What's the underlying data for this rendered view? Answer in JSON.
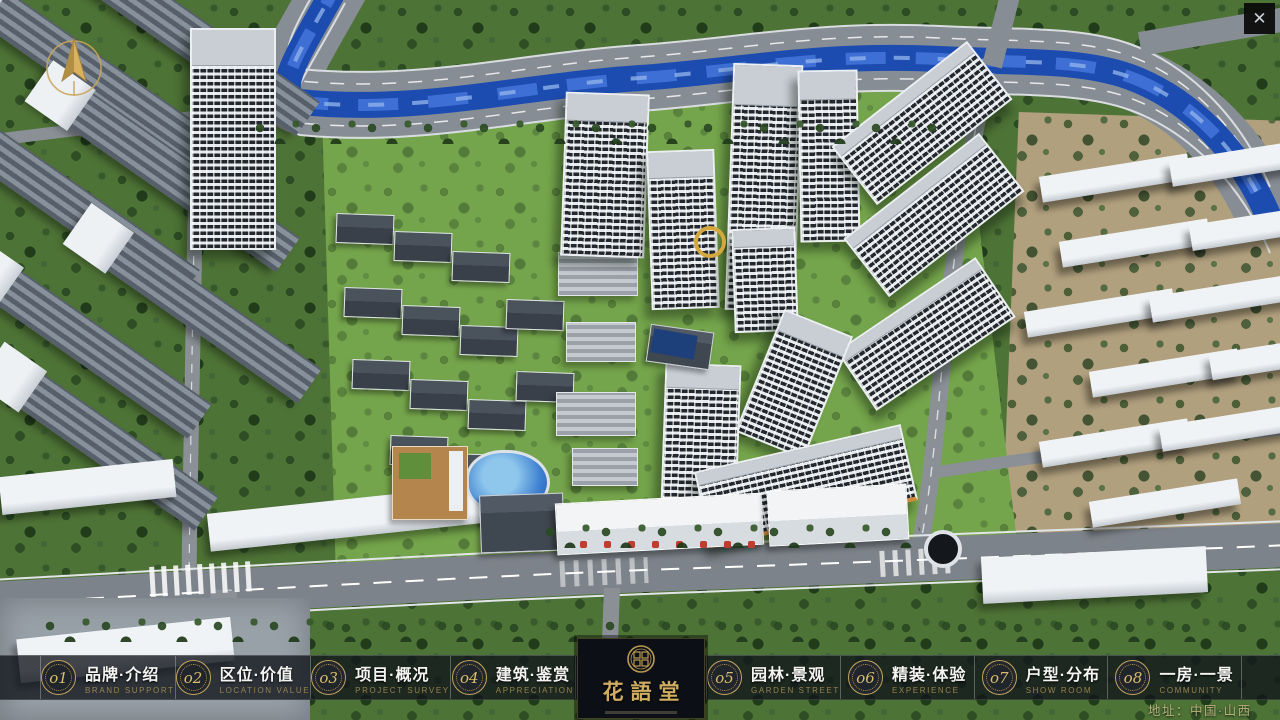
{
  "window": {
    "title": "花語堂 沙盘展示",
    "close_glyph": "✕"
  },
  "icons": {
    "compass": "compass-north-icon",
    "close": "close-icon",
    "seal": "brand-seal-icon"
  },
  "logo": {
    "name": "花語堂"
  },
  "nav": {
    "items": [
      {
        "num": "o1",
        "label": "品牌·介绍",
        "sublabel": "BRAND SUPPORT"
      },
      {
        "num": "o2",
        "label": "区位·价值",
        "sublabel": "LOCATION VALUE"
      },
      {
        "num": "o3",
        "label": "项目·概况",
        "sublabel": "PROJECT SURVEY"
      },
      {
        "num": "o4",
        "label": "建筑·鉴赏",
        "sublabel": "APPRECIATION"
      },
      {
        "num": "o5",
        "label": "园林·景观",
        "sublabel": "GARDEN STREET"
      },
      {
        "num": "o6",
        "label": "精装·体验",
        "sublabel": "EXPERIENCE"
      },
      {
        "num": "o7",
        "label": "户型·分布",
        "sublabel": "SHOW ROOM"
      },
      {
        "num": "o8",
        "label": "一房·一景",
        "sublabel": "COMMUNITY"
      }
    ]
  },
  "footer": {
    "address": "地址：中国·山西"
  },
  "colors": {
    "gold_accent": "#c9a95c",
    "nav_background": "rgba(15,19,25,0.78)",
    "river_blue": "#1e4fb4",
    "lawn_green": "#74a44b",
    "road_gray": "#878d94"
  }
}
